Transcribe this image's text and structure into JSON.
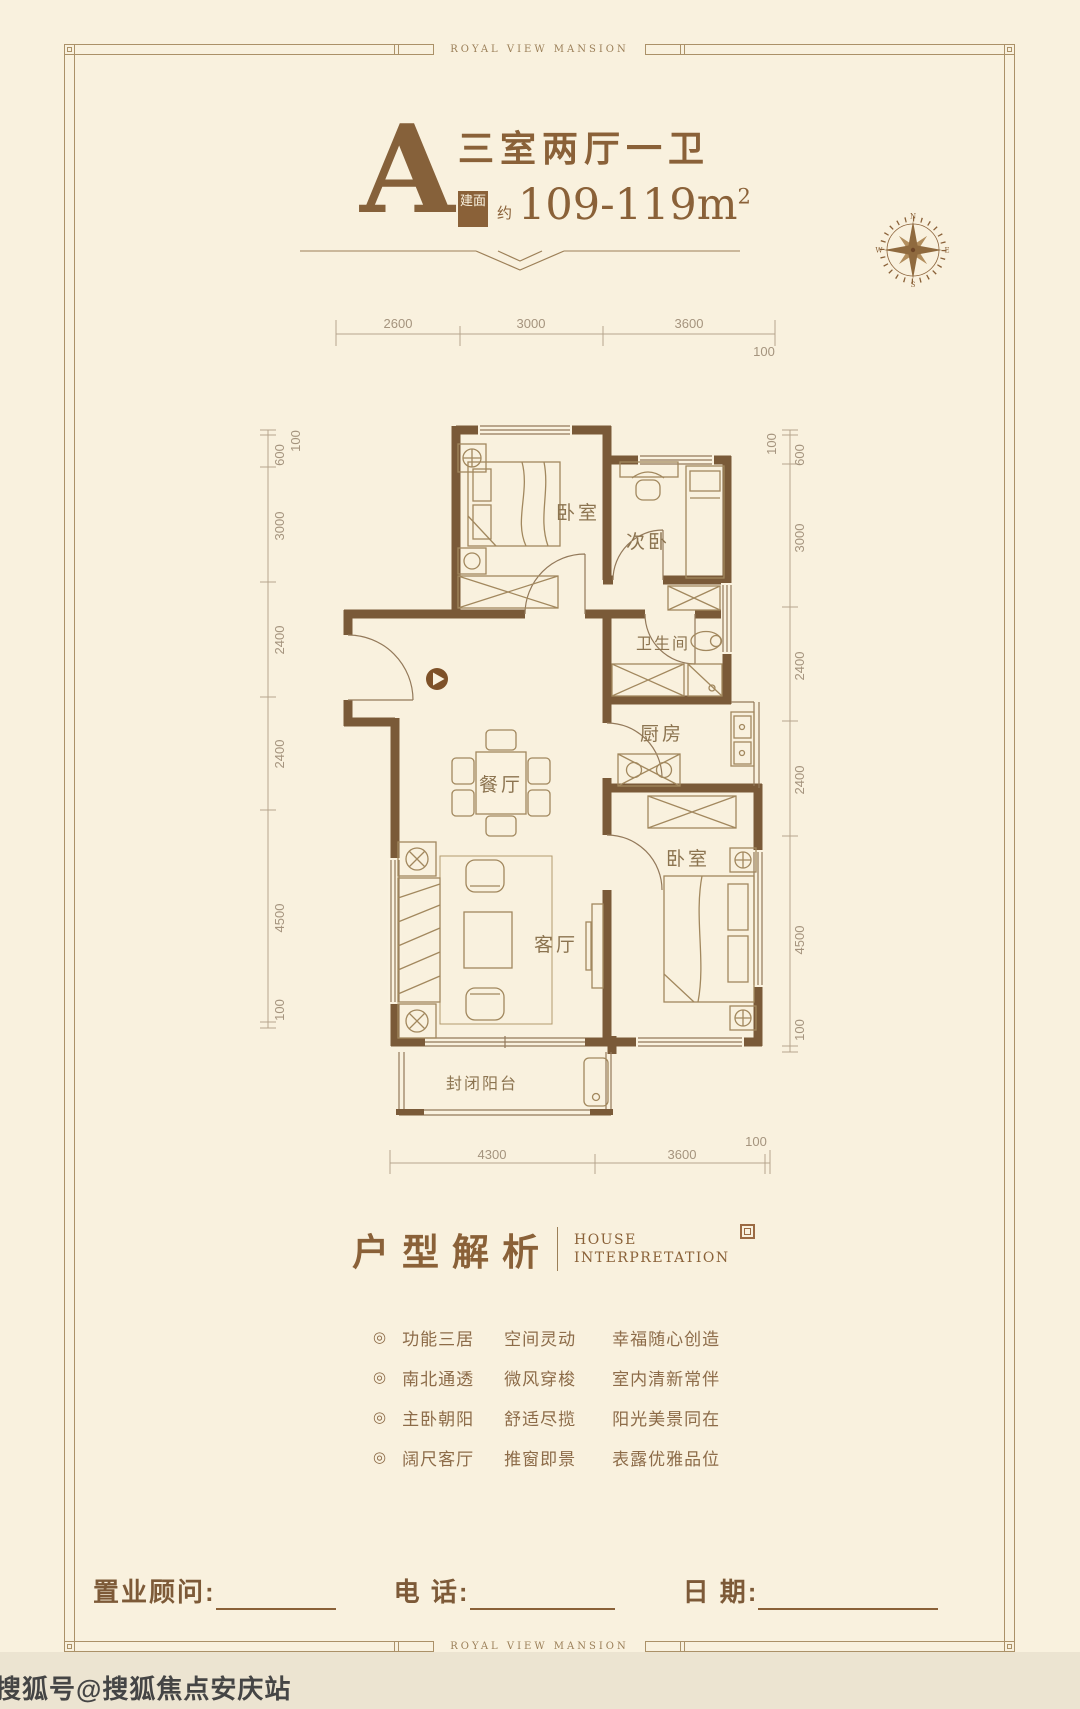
{
  "page": {
    "brand": "ROYAL VIEW MANSION",
    "watermark": "搜狐号@搜狐焦点安庆站"
  },
  "header": {
    "unit_letter": "A",
    "unit_title": "三室两厅一卫",
    "area_tag": "建面",
    "area_approx": "约",
    "area_value": "109-119m",
    "area_exp": "2"
  },
  "compass": {
    "n": "N",
    "e": "E",
    "s": "S",
    "w": "W"
  },
  "plan": {
    "rooms": [
      {
        "label": "卧室"
      },
      {
        "label": "次卧"
      },
      {
        "label": "卫生间"
      },
      {
        "label": "厨房"
      },
      {
        "label": "餐厅"
      },
      {
        "label": "客厅"
      },
      {
        "label": "卧室"
      },
      {
        "label": "封闭阳台"
      }
    ],
    "dims_top": [
      "2600",
      "3000",
      "3600"
    ],
    "dims_top_end": "100",
    "dims_bottom": [
      "4300",
      "3600"
    ],
    "dims_bottom_end": "100",
    "dims_left": [
      "100",
      "600",
      "3000",
      "2400",
      "2400",
      "4500",
      "100"
    ],
    "dims_right": [
      "100",
      "600",
      "3000",
      "2400",
      "2400",
      "4500",
      "100"
    ]
  },
  "section": {
    "title": "户型解析",
    "subtitle_en_1": "HOUSE",
    "subtitle_en_2": "INTERPRETATION"
  },
  "features": {
    "bullet": "◎",
    "rows": [
      {
        "c1": "功能三居",
        "c2": "空间灵动",
        "c3": "幸福随心创造"
      },
      {
        "c1": "南北通透",
        "c2": "微风穿梭",
        "c3": "室内清新常伴"
      },
      {
        "c1": "主卧朝阳",
        "c2": "舒适尽揽",
        "c3": "阳光美景同在"
      },
      {
        "c1": "阔尺客厅",
        "c2": "推窗即景",
        "c3": "表露优雅品位"
      }
    ]
  },
  "footer": {
    "consultant_label": "置业顾问:",
    "phone_label": "电 话:",
    "date_label": "日 期:"
  },
  "colors": {
    "accent": "#8a6138",
    "wall": "#7a5a38",
    "background": "#f9f1de",
    "dim_text": "#a5947e",
    "watermark_text": "#454545"
  }
}
